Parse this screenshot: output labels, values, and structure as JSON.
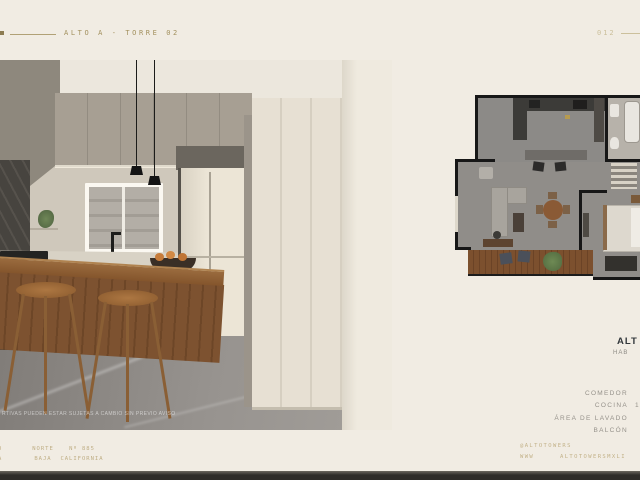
{
  "header": {
    "project_label": "ALTO A - TORRE 02",
    "page_number": "012"
  },
  "photo": {
    "disclaimer": "RTIVAS PUEDEN ESTAR SUJETAS A CAMBIO SIN PREVIO AVISO"
  },
  "plan_info": {
    "title": "ALT",
    "subtitle": "HAB",
    "rooms": [
      {
        "label": "COMEDOR",
        "value": ""
      },
      {
        "label": "COCINA",
        "value": "1"
      },
      {
        "label": "ÁREA DE LAVADO",
        "value": ""
      },
      {
        "label": "BALCÓN",
        "value": ""
      }
    ]
  },
  "footer": {
    "address_blocks": [
      {
        "line1": "DO",
        "line2": "NA"
      },
      {
        "line1": "NORTE",
        "line2": "BAJA"
      },
      {
        "line1": "Nº 885",
        "line2": "CALIFORNIA"
      }
    ],
    "social_handle": "@ALTOTOWERS",
    "website_www": "WWW",
    "website_domain": "ALTOTOWERSMXLI"
  },
  "colors": {
    "background": "#f1ece3",
    "gold": "#a3915f",
    "gold_faint": "#ccc09c",
    "title_dark": "#32373b",
    "muted_text": "#95918a",
    "wall_dark": "#171717",
    "wood": "#8a5c33"
  }
}
